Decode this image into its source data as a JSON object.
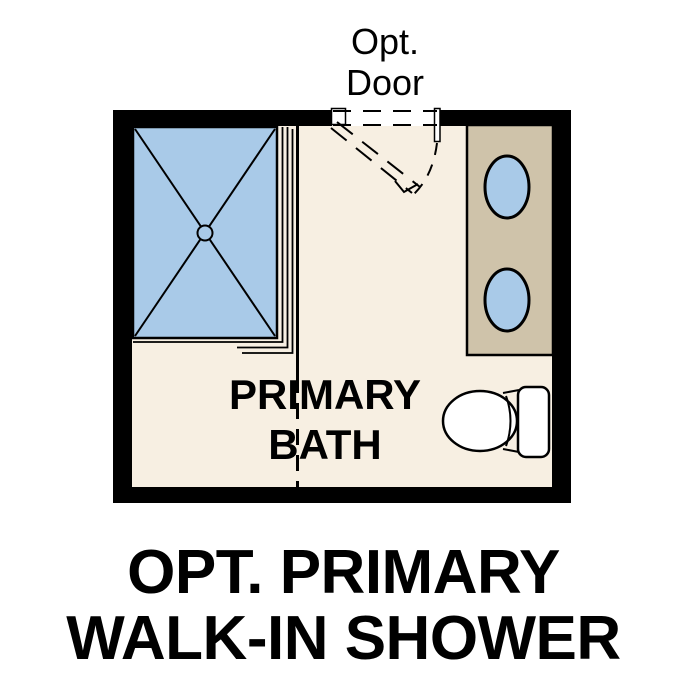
{
  "door_label": {
    "line1": "Opt.",
    "line2": "Door"
  },
  "room_label": {
    "line1": "PRIMARY",
    "line2": "BATH"
  },
  "caption": {
    "line1": "OPT. PRIMARY",
    "line2": "WALK-IN SHOWER"
  },
  "colors": {
    "background": "#ffffff",
    "wall": "#000000",
    "floor": "#f7efe2",
    "fixture_blue": "#a9cae8",
    "vanity_tan": "#cfc3aa",
    "fixture_white": "#ffffff",
    "line": "#000000",
    "text": "#000000"
  }
}
